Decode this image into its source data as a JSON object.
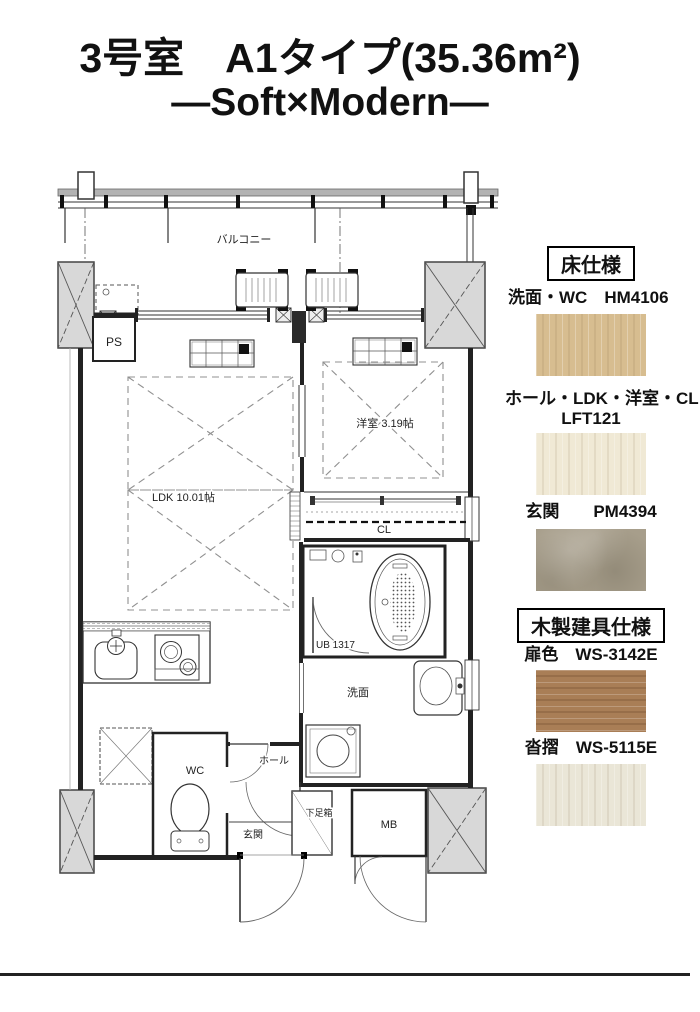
{
  "header": {
    "line1": "3号室　A1タイプ(35.36m²)",
    "line2": "—Soft×Modern—"
  },
  "plan": {
    "labels": {
      "balcony": "バルコニー",
      "ps": "PS",
      "western_room": "洋室 3.19帖",
      "ldk": "LDK 10.01帖",
      "closet": "CL",
      "unit_bath": "UB 1317",
      "washroom": "洗面",
      "wc": "WC",
      "hall": "ホール",
      "shoe_box": "下足箱",
      "entrance": "玄関",
      "meter_box": "MB"
    }
  },
  "specs": {
    "floor": {
      "heading": "床仕様",
      "items": [
        {
          "label": "洗面・WC　HM4106",
          "code": "HM4106",
          "color": "#d7bd90",
          "texture": "wood-v"
        },
        {
          "label": "ホール・LDK・洋室・CL",
          "label2": "LFT121",
          "code": "LFT121",
          "color": "#f0e9d5",
          "texture": "wood-v"
        },
        {
          "label": "玄関　　PM4394",
          "code": "PM4394",
          "color": "#a79e8b",
          "texture": "stone"
        }
      ]
    },
    "fixtures": {
      "heading": "木製建具仕様",
      "items": [
        {
          "label": "扉色　WS-3142E",
          "code": "WS-3142E",
          "color": "#a97e56",
          "texture": "wood-h"
        },
        {
          "label": "沓摺　WS-5115E",
          "code": "WS-5115E",
          "color": "#eae6d7",
          "texture": "wood-v"
        }
      ]
    }
  }
}
